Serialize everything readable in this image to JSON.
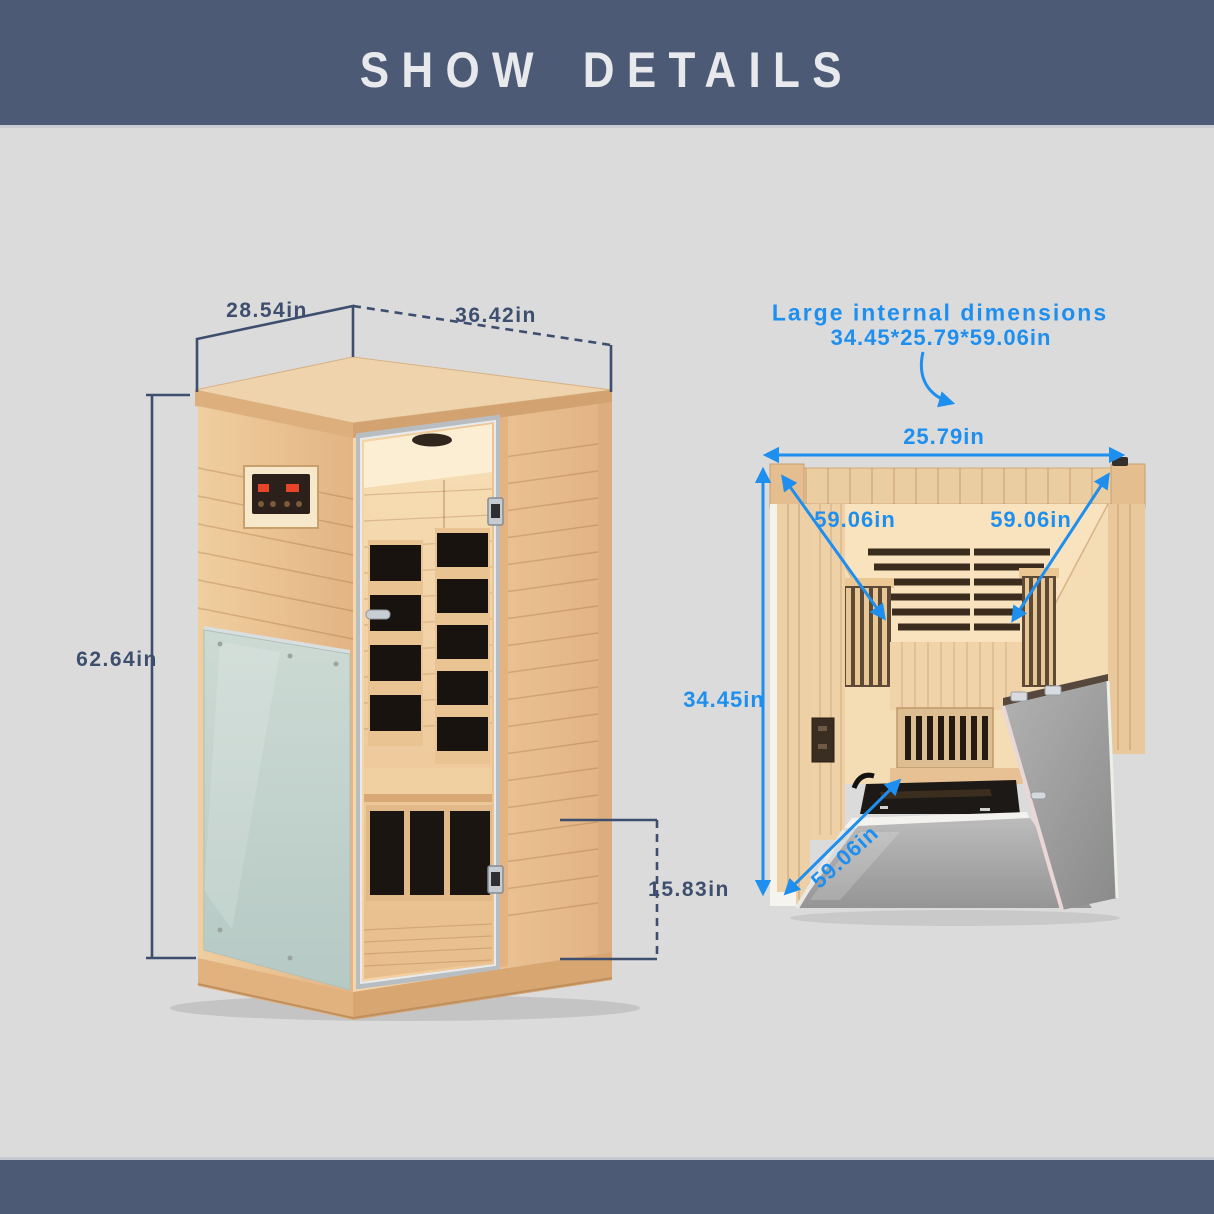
{
  "header": {
    "title": "SHOW DETAILS"
  },
  "left_figure": {
    "alt": "sauna-exterior-three-quarter-view",
    "labels": {
      "depth": "28.54in",
      "width": "36.42in",
      "height": "62.64in",
      "base_height": "15.83in"
    }
  },
  "right_figure": {
    "alt": "sauna-internal-top-view",
    "callout_title": "Large internal dimensions",
    "callout_value": "34.45*25.79*59.06in",
    "labels": {
      "internal_width": "25.79in",
      "wall_diagonal_left": "59.06in",
      "wall_diagonal_right": "59.06in",
      "internal_depth": "34.45in",
      "floor_diagonal": "59.06in"
    }
  },
  "colors": {
    "band": "#4C5A76",
    "background": "#DBDBDB",
    "dimension_line": "#3D4E6E",
    "accent_blue": "#1E8FEF"
  }
}
